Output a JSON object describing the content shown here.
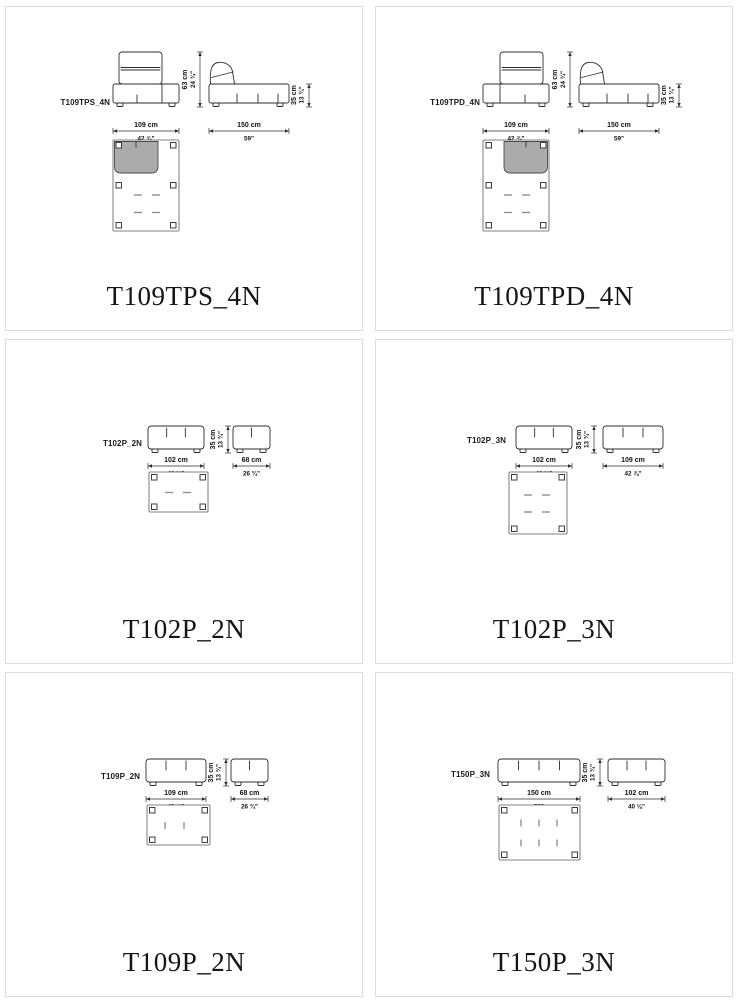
{
  "colors": {
    "shaded_seat": "#ababab",
    "cell_border": "#dcdcdc",
    "line": "#2e2e2e"
  },
  "cells": [
    {
      "code": "T109TPS_4N",
      "small_label": "T109TPS_4N",
      "front_width_cm": "109 cm",
      "front_width_in": "42 ⅞\"",
      "side_width_cm": "150 cm",
      "side_width_in": "59\"",
      "back_height_cm": "63 cm",
      "back_height_in": "24 ¾\"",
      "seat_height_cm": "35 cm",
      "seat_height_in": "13 ¾\""
    },
    {
      "code": "T109TPD_4N",
      "small_label": "T109TPD_4N",
      "front_width_cm": "109 cm",
      "front_width_in": "42 ⅞\"",
      "side_width_cm": "150 cm",
      "side_width_in": "59\"",
      "back_height_cm": "63 cm",
      "back_height_in": "24 ¾\"",
      "seat_height_cm": "35 cm",
      "seat_height_in": "13 ¾\""
    },
    {
      "code": "T102P_2N",
      "small_label": "T102P_2N",
      "front_width_cm": "102 cm",
      "front_width_in": "40 ⅛\"",
      "side_width_cm": "68 cm",
      "side_width_in": "26 ¾\"",
      "seat_height_cm": "35 cm",
      "seat_height_in": "13 ¾\""
    },
    {
      "code": "T102P_3N",
      "small_label": "T102P_3N",
      "front_width_cm": "102 cm",
      "front_width_in": "40 ⅛\"",
      "side_width_cm": "109 cm",
      "side_width_in": "42 ⅞\"",
      "seat_height_cm": "35 cm",
      "seat_height_in": "13 ¾\""
    },
    {
      "code": "T109P_2N",
      "small_label": "T109P_2N",
      "front_width_cm": "109 cm",
      "front_width_in": "42 ⅞\"",
      "side_width_cm": "68 cm",
      "side_width_in": "26 ¾\"",
      "seat_height_cm": "35 cm",
      "seat_height_in": "13 ¾\""
    },
    {
      "code": "T150P_3N",
      "small_label": "T150P_3N",
      "front_width_cm": "150 cm",
      "front_width_in": "59\"",
      "side_width_cm": "102 cm",
      "side_width_in": "40 ⅛\"",
      "seat_height_cm": "35 cm",
      "seat_height_in": "13 ¾\""
    }
  ]
}
